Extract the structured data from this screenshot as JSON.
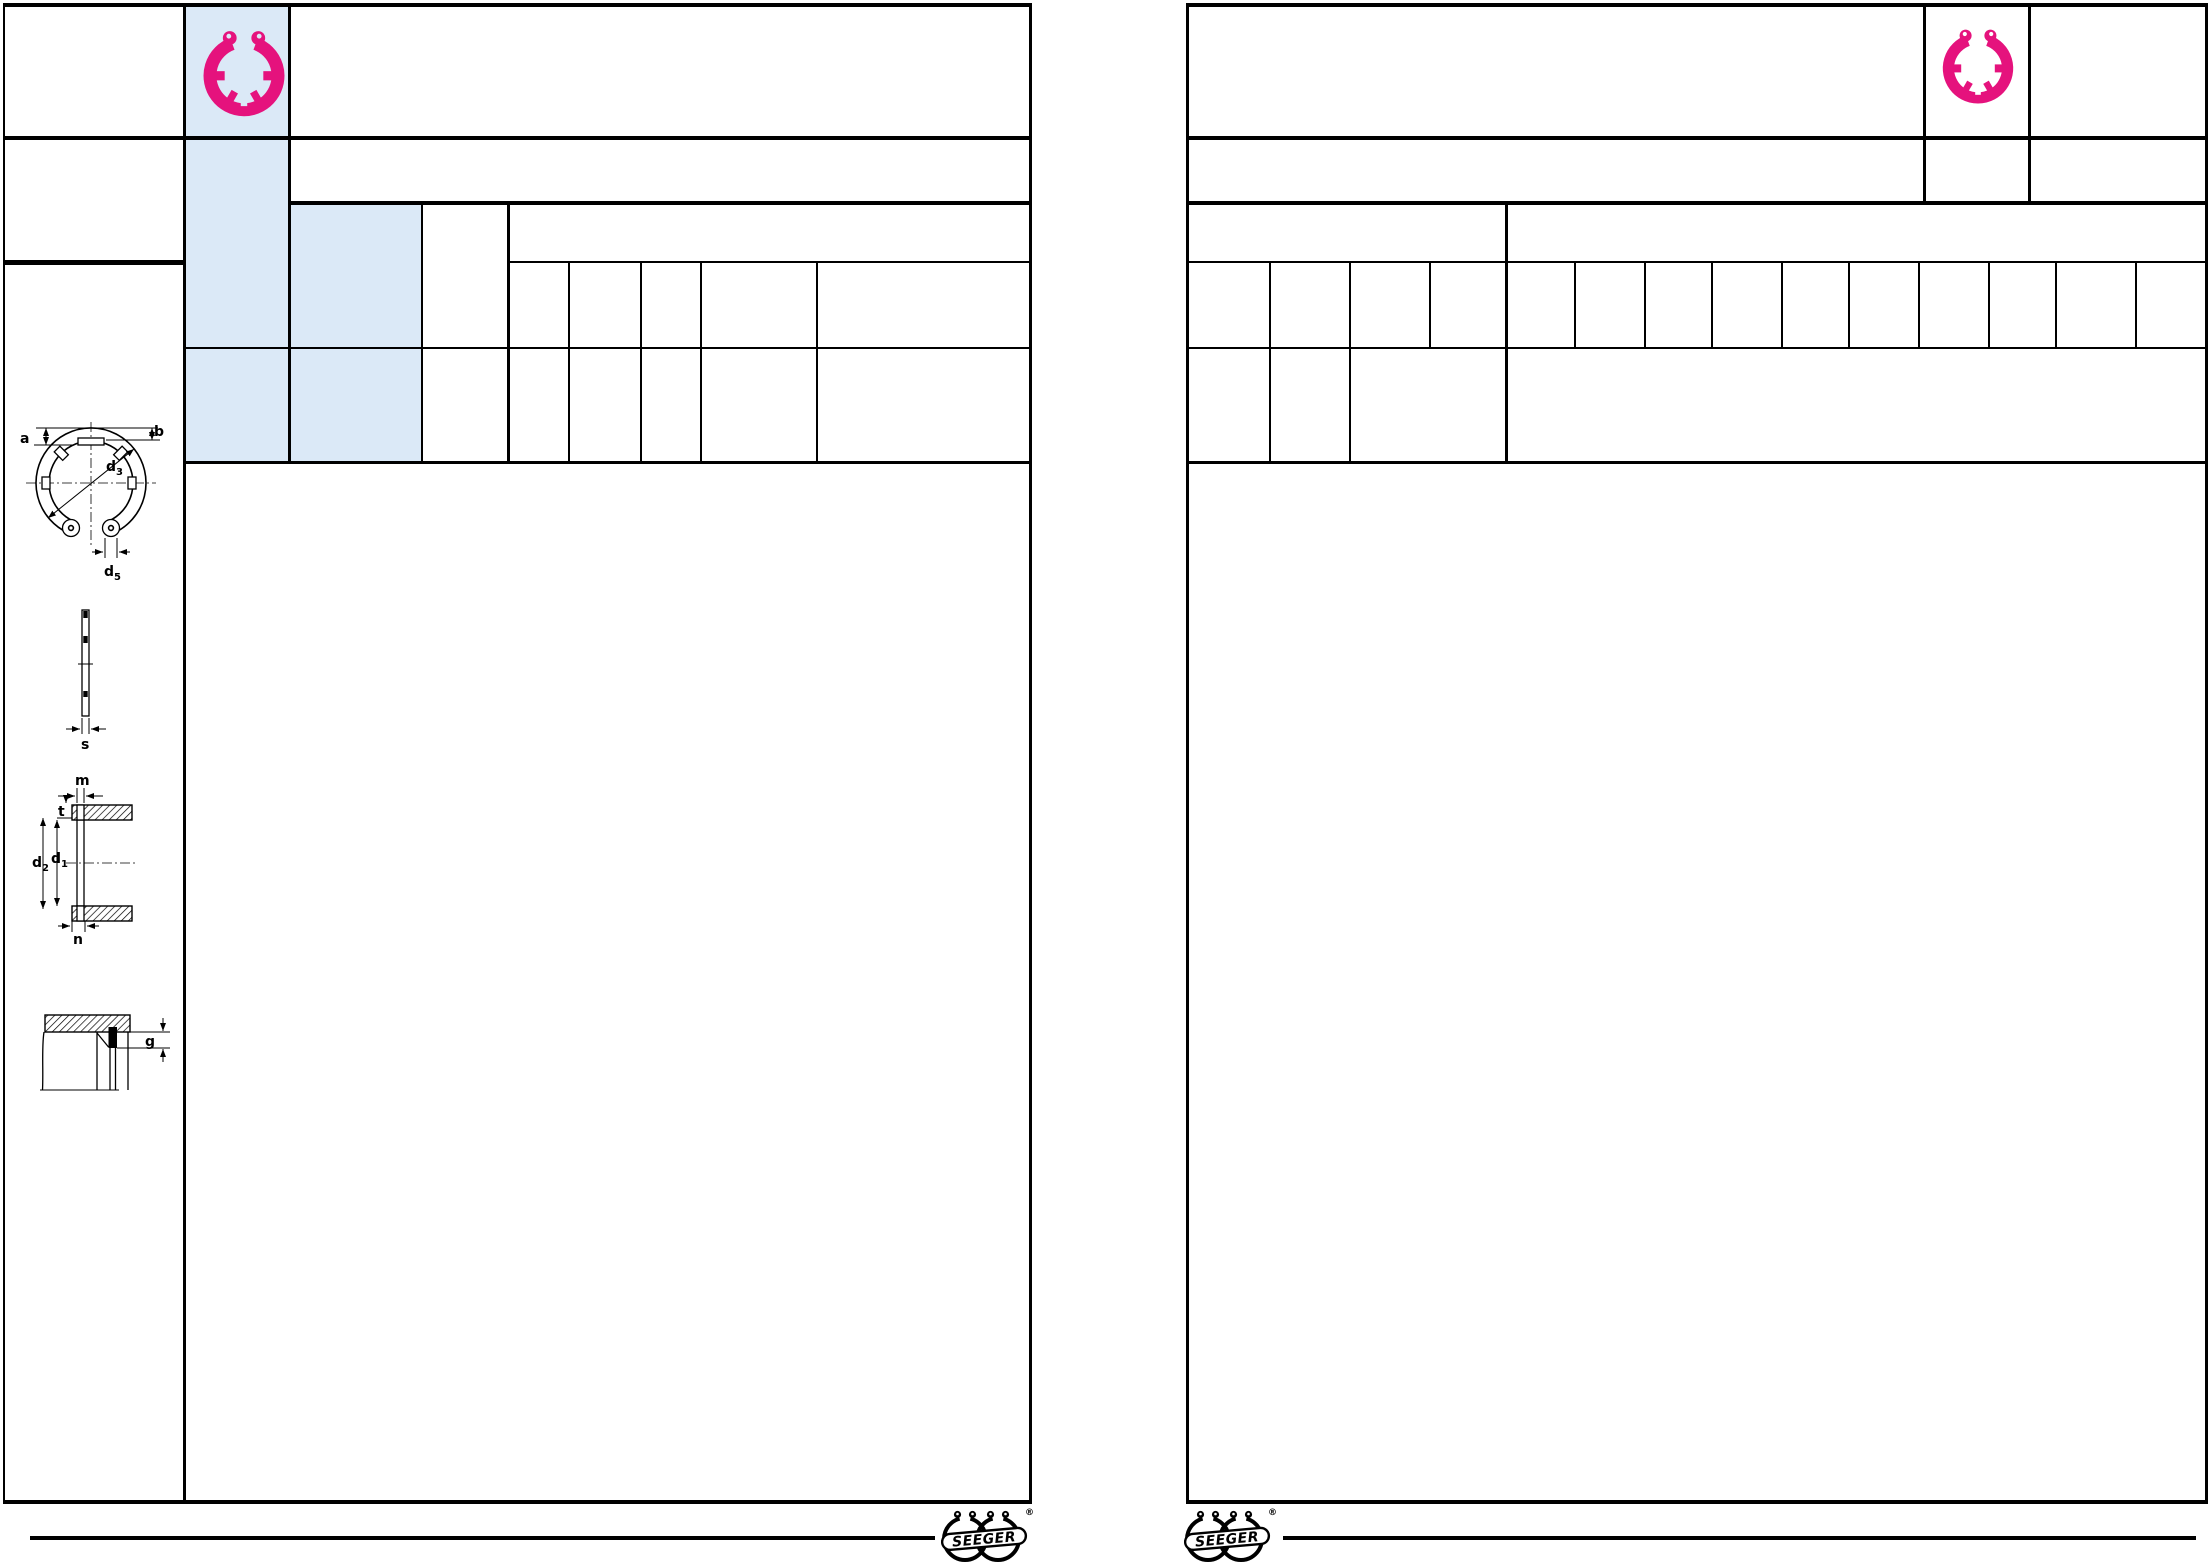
{
  "colors": {
    "accent_pink": "#e5127d",
    "panel_blue": "#dbe9f7",
    "line": "#000000",
    "background": "#ffffff"
  },
  "header": {
    "left_page_icon": "internal-circlip-ring",
    "right_page_icon": "internal-circlip-ring"
  },
  "drawings": {
    "front_view": {
      "label_a": "a",
      "label_b": "b",
      "label_d3_main": "d",
      "label_d3_sub": "3",
      "label_d5_main": "d",
      "label_d5_sub": "5"
    },
    "side_view": {
      "label_s": "s"
    },
    "groove_section": {
      "label_m": "m",
      "label_t": "t",
      "label_d2_main": "d",
      "label_d2_sub": "2",
      "label_d1_main": "d",
      "label_d1_sub": "1",
      "label_n": "n"
    },
    "edge_detail": {
      "label_g": "g"
    }
  },
  "footer": {
    "brand": "SEEGER",
    "registered": "®"
  }
}
